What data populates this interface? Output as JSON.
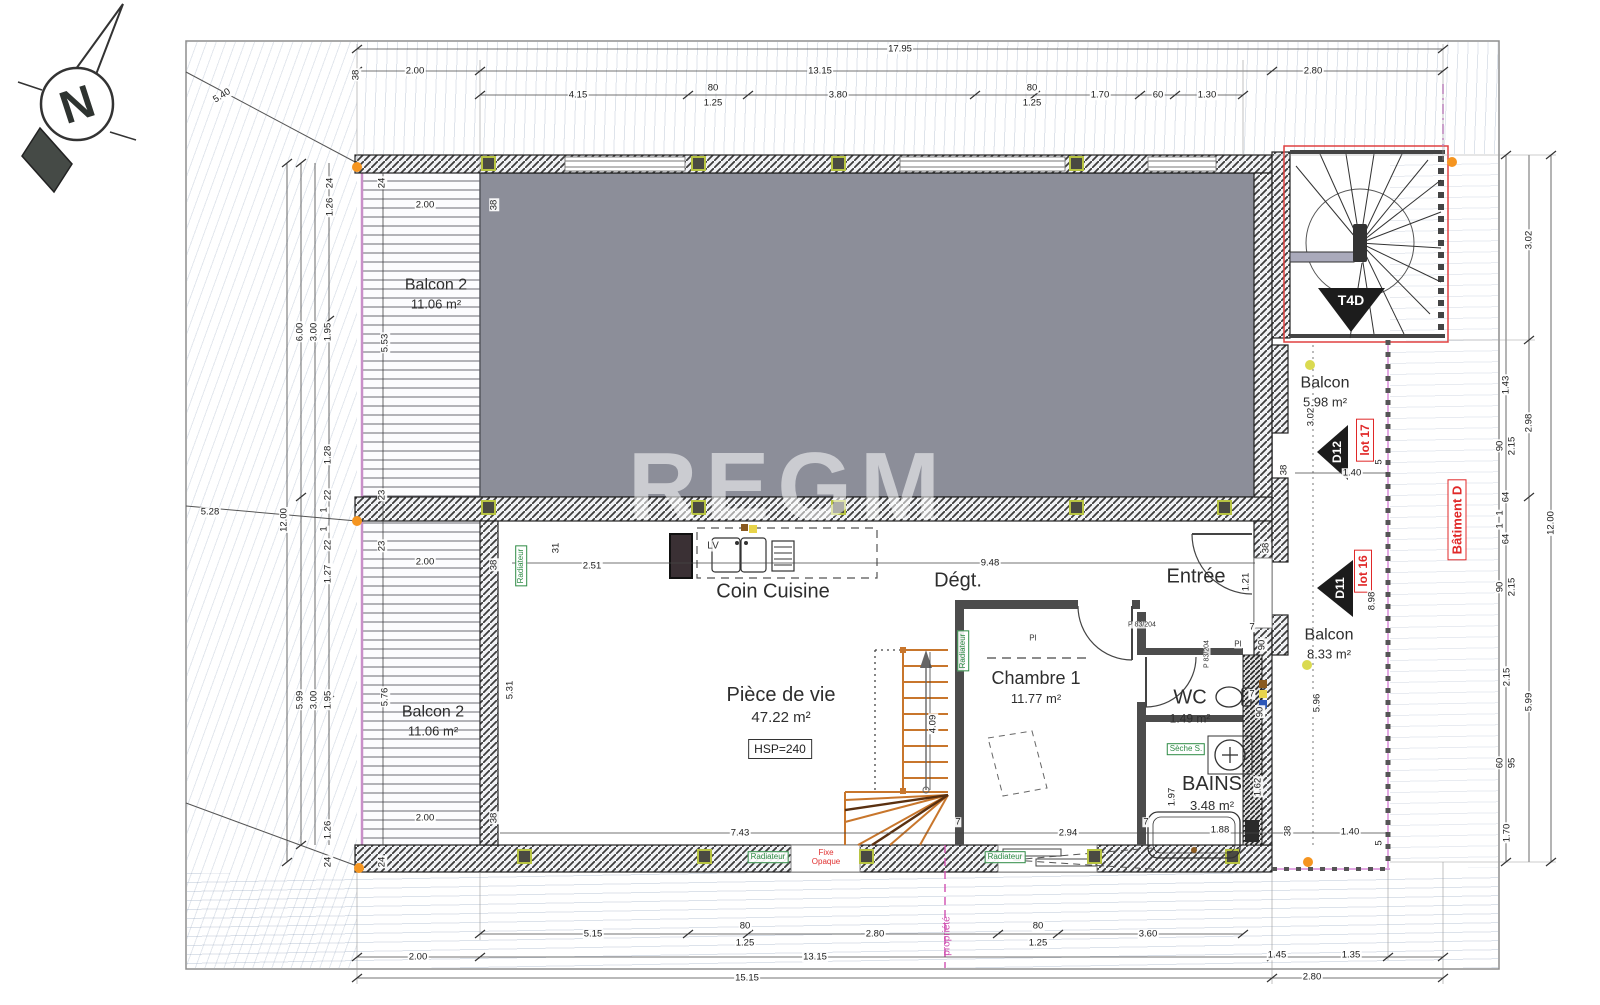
{
  "watermark": "REGM",
  "compass": {
    "letter": "N"
  },
  "rooms": {
    "balcon2_top": {
      "name": "Balcon 2",
      "area": "11.06 m²"
    },
    "balcon2_bottom": {
      "name": "Balcon 2",
      "area": "11.06 m²"
    },
    "coin_cuisine": {
      "name": "Coin Cuisine"
    },
    "piece_de_vie": {
      "name": "Pièce de vie",
      "area": "47.22 m²",
      "hsp": "HSP=240"
    },
    "degagement": {
      "name": "Dégt."
    },
    "entree": {
      "name": "Entrée"
    },
    "chambre1": {
      "name": "Chambre 1",
      "area": "11.77 m²"
    },
    "wc": {
      "name": "WC",
      "area": "1.49 m²"
    },
    "bains": {
      "name": "BAINS",
      "area": "3.48 m²"
    },
    "balcon_nord": {
      "name": "Balcon",
      "area": "5.98 m²"
    },
    "balcon_sud": {
      "name": "Balcon",
      "area": "8.33 m²"
    }
  },
  "markers": {
    "t4d": "T4D",
    "d12": "D12",
    "d11": "D11",
    "lot17": "lot 17",
    "lot16": "lot 16",
    "batiment": "Bâtiment D",
    "propriete": "propriété",
    "lv": "LV",
    "pi": "PI",
    "door_ref": "P 83/204",
    "radiateur": "Radiateur",
    "seche": "Sèche S.",
    "fixe_line1": "Fixe",
    "fixe_line2": "Opaque"
  },
  "colors": {
    "accent_red": "#e02828",
    "accent_magenta": "#cf4fb0",
    "accent_green": "#2e8b45",
    "stair_orange": "#c8762c",
    "upper_gray": "#8c8e99"
  },
  "radiators": [
    {
      "x": 521,
      "y": 566,
      "r": 1
    },
    {
      "x": 963,
      "y": 651,
      "r": 1
    },
    {
      "x": 768,
      "y": 857,
      "r": 0
    },
    {
      "x": 1005,
      "y": 857,
      "r": 0
    }
  ],
  "dims": [
    {
      "t": "17.95",
      "x": 900,
      "y": 49
    },
    {
      "t": "2.00",
      "x": 415,
      "y": 71
    },
    {
      "t": "13.15",
      "x": 820,
      "y": 71
    },
    {
      "t": "2.80",
      "x": 1313,
      "y": 71
    },
    {
      "t": "4.15",
      "x": 578,
      "y": 95
    },
    {
      "t": "80",
      "x": 713,
      "y": 88
    },
    {
      "t": "1.25",
      "x": 713,
      "y": 103
    },
    {
      "t": "3.80",
      "x": 838,
      "y": 95
    },
    {
      "t": "80",
      "x": 1032,
      "y": 88
    },
    {
      "t": "1.25",
      "x": 1032,
      "y": 103
    },
    {
      "t": "1.70",
      "x": 1100,
      "y": 95
    },
    {
      "t": "60",
      "x": 1158,
      "y": 95
    },
    {
      "t": "1.30",
      "x": 1207,
      "y": 95
    },
    {
      "t": "5.40",
      "x": 222,
      "y": 96,
      "a": -32
    },
    {
      "t": "5.28",
      "x": 210,
      "y": 512
    },
    {
      "t": "38",
      "x": 356,
      "y": 75,
      "r": 1
    },
    {
      "t": "12.00",
      "x": 284,
      "y": 520,
      "r": 1
    },
    {
      "t": "6.00",
      "x": 300,
      "y": 332,
      "r": 1
    },
    {
      "t": "3.00",
      "x": 314,
      "y": 332,
      "r": 1
    },
    {
      "t": "1.95",
      "x": 328,
      "y": 332,
      "r": 1
    },
    {
      "t": "24",
      "x": 330,
      "y": 183,
      "r": 1
    },
    {
      "t": "1.26",
      "x": 330,
      "y": 207,
      "r": 1
    },
    {
      "t": "1.28",
      "x": 328,
      "y": 455,
      "r": 1
    },
    {
      "t": "22",
      "x": 328,
      "y": 495,
      "r": 1
    },
    {
      "t": "1",
      "x": 324,
      "y": 510,
      "r": 1
    },
    {
      "t": "1",
      "x": 324,
      "y": 529,
      "r": 1
    },
    {
      "t": "22",
      "x": 328,
      "y": 545,
      "r": 1
    },
    {
      "t": "1.27",
      "x": 328,
      "y": 574,
      "r": 1
    },
    {
      "t": "5.99",
      "x": 300,
      "y": 700,
      "r": 1
    },
    {
      "t": "3.00",
      "x": 314,
      "y": 700,
      "r": 1
    },
    {
      "t": "1.95",
      "x": 328,
      "y": 700,
      "r": 1
    },
    {
      "t": "1.26",
      "x": 328,
      "y": 830,
      "r": 1
    },
    {
      "t": "24",
      "x": 328,
      "y": 862,
      "r": 1
    },
    {
      "t": "24",
      "x": 382,
      "y": 183,
      "r": 1
    },
    {
      "t": "5.53",
      "x": 385,
      "y": 343,
      "r": 1
    },
    {
      "t": "23",
      "x": 382,
      "y": 495,
      "r": 1
    },
    {
      "t": "23",
      "x": 382,
      "y": 546,
      "r": 1
    },
    {
      "t": "5.76",
      "x": 385,
      "y": 697,
      "r": 1
    },
    {
      "t": "24",
      "x": 382,
      "y": 862,
      "r": 1
    },
    {
      "t": "2.00",
      "x": 425,
      "y": 205
    },
    {
      "t": "2.00",
      "x": 425,
      "y": 562
    },
    {
      "t": "2.00",
      "x": 425,
      "y": 818
    },
    {
      "t": "38",
      "x": 494,
      "y": 205,
      "r": 1
    },
    {
      "t": "38",
      "x": 494,
      "y": 565,
      "r": 1
    },
    {
      "t": "38",
      "x": 494,
      "y": 818,
      "r": 1
    },
    {
      "t": "31",
      "x": 556,
      "y": 548,
      "r": 1
    },
    {
      "t": "2.51",
      "x": 592,
      "y": 566
    },
    {
      "t": "5.31",
      "x": 510,
      "y": 690,
      "r": 1
    },
    {
      "t": "9.48",
      "x": 990,
      "y": 563
    },
    {
      "t": "1.21",
      "x": 1246,
      "y": 582,
      "r": 1
    },
    {
      "t": "38",
      "x": 1266,
      "y": 548,
      "r": 1
    },
    {
      "t": "4.09",
      "x": 933,
      "y": 724,
      "r": 1
    },
    {
      "t": "7.43",
      "x": 740,
      "y": 833
    },
    {
      "t": "7",
      "x": 958,
      "y": 822
    },
    {
      "t": "2.94",
      "x": 1068,
      "y": 833
    },
    {
      "t": "7",
      "x": 1146,
      "y": 822
    },
    {
      "t": "1.88",
      "x": 1220,
      "y": 830
    },
    {
      "t": "38",
      "x": 1288,
      "y": 831,
      "r": 1
    },
    {
      "t": "1.40",
      "x": 1350,
      "y": 832
    },
    {
      "t": "5",
      "x": 1379,
      "y": 843,
      "r": 1
    },
    {
      "t": "7",
      "x": 1252,
      "y": 627
    },
    {
      "t": "90",
      "x": 1262,
      "y": 645,
      "r": 1
    },
    {
      "t": "90",
      "x": 1260,
      "y": 712,
      "r": 1
    },
    {
      "t": "7",
      "x": 1252,
      "y": 694
    },
    {
      "t": "1.97",
      "x": 1172,
      "y": 797,
      "r": 1
    },
    {
      "t": "1.62",
      "x": 1258,
      "y": 787,
      "r": 1
    },
    {
      "t": "3.02",
      "x": 1311,
      "y": 417,
      "r": 1
    },
    {
      "t": "1.40",
      "x": 1352,
      "y": 473
    },
    {
      "t": "5",
      "x": 1379,
      "y": 462,
      "r": 1
    },
    {
      "t": "38",
      "x": 1284,
      "y": 470,
      "r": 1
    },
    {
      "t": "5.96",
      "x": 1317,
      "y": 703,
      "r": 1
    },
    {
      "t": "8.98",
      "x": 1372,
      "y": 601,
      "r": 1
    },
    {
      "t": "3.02",
      "x": 1529,
      "y": 240,
      "r": 1
    },
    {
      "t": "1.43",
      "x": 1506,
      "y": 385,
      "r": 1
    },
    {
      "t": "2.98",
      "x": 1529,
      "y": 423,
      "r": 1
    },
    {
      "t": "90",
      "x": 1500,
      "y": 446,
      "r": 1
    },
    {
      "t": "2.15",
      "x": 1512,
      "y": 446,
      "r": 1
    },
    {
      "t": "64",
      "x": 1506,
      "y": 497,
      "r": 1
    },
    {
      "t": "1",
      "x": 1500,
      "y": 513,
      "r": 1
    },
    {
      "t": "1",
      "x": 1500,
      "y": 526,
      "r": 1
    },
    {
      "t": "64",
      "x": 1506,
      "y": 539,
      "r": 1
    },
    {
      "t": "90",
      "x": 1500,
      "y": 587,
      "r": 1
    },
    {
      "t": "2.15",
      "x": 1512,
      "y": 587,
      "r": 1
    },
    {
      "t": "2.15",
      "x": 1507,
      "y": 677,
      "r": 1
    },
    {
      "t": "5.99",
      "x": 1529,
      "y": 702,
      "r": 1
    },
    {
      "t": "60",
      "x": 1500,
      "y": 763,
      "r": 1
    },
    {
      "t": "95",
      "x": 1512,
      "y": 763,
      "r": 1
    },
    {
      "t": "1.70",
      "x": 1507,
      "y": 833,
      "r": 1
    },
    {
      "t": "12.00",
      "x": 1551,
      "y": 523,
      "r": 1
    },
    {
      "t": "5.15",
      "x": 593,
      "y": 934
    },
    {
      "t": "80",
      "x": 745,
      "y": 926
    },
    {
      "t": "1.25",
      "x": 745,
      "y": 943
    },
    {
      "t": "2.80",
      "x": 875,
      "y": 934
    },
    {
      "t": "80",
      "x": 1038,
      "y": 926
    },
    {
      "t": "1.25",
      "x": 1038,
      "y": 943
    },
    {
      "t": "3.60",
      "x": 1148,
      "y": 934
    },
    {
      "t": "2.00",
      "x": 418,
      "y": 957
    },
    {
      "t": "13.15",
      "x": 815,
      "y": 957
    },
    {
      "t": "1.45",
      "x": 1277,
      "y": 955
    },
    {
      "t": "1.35",
      "x": 1351,
      "y": 955
    },
    {
      "t": "15.15",
      "x": 747,
      "y": 978
    },
    {
      "t": "2.80",
      "x": 1312,
      "y": 977
    }
  ]
}
